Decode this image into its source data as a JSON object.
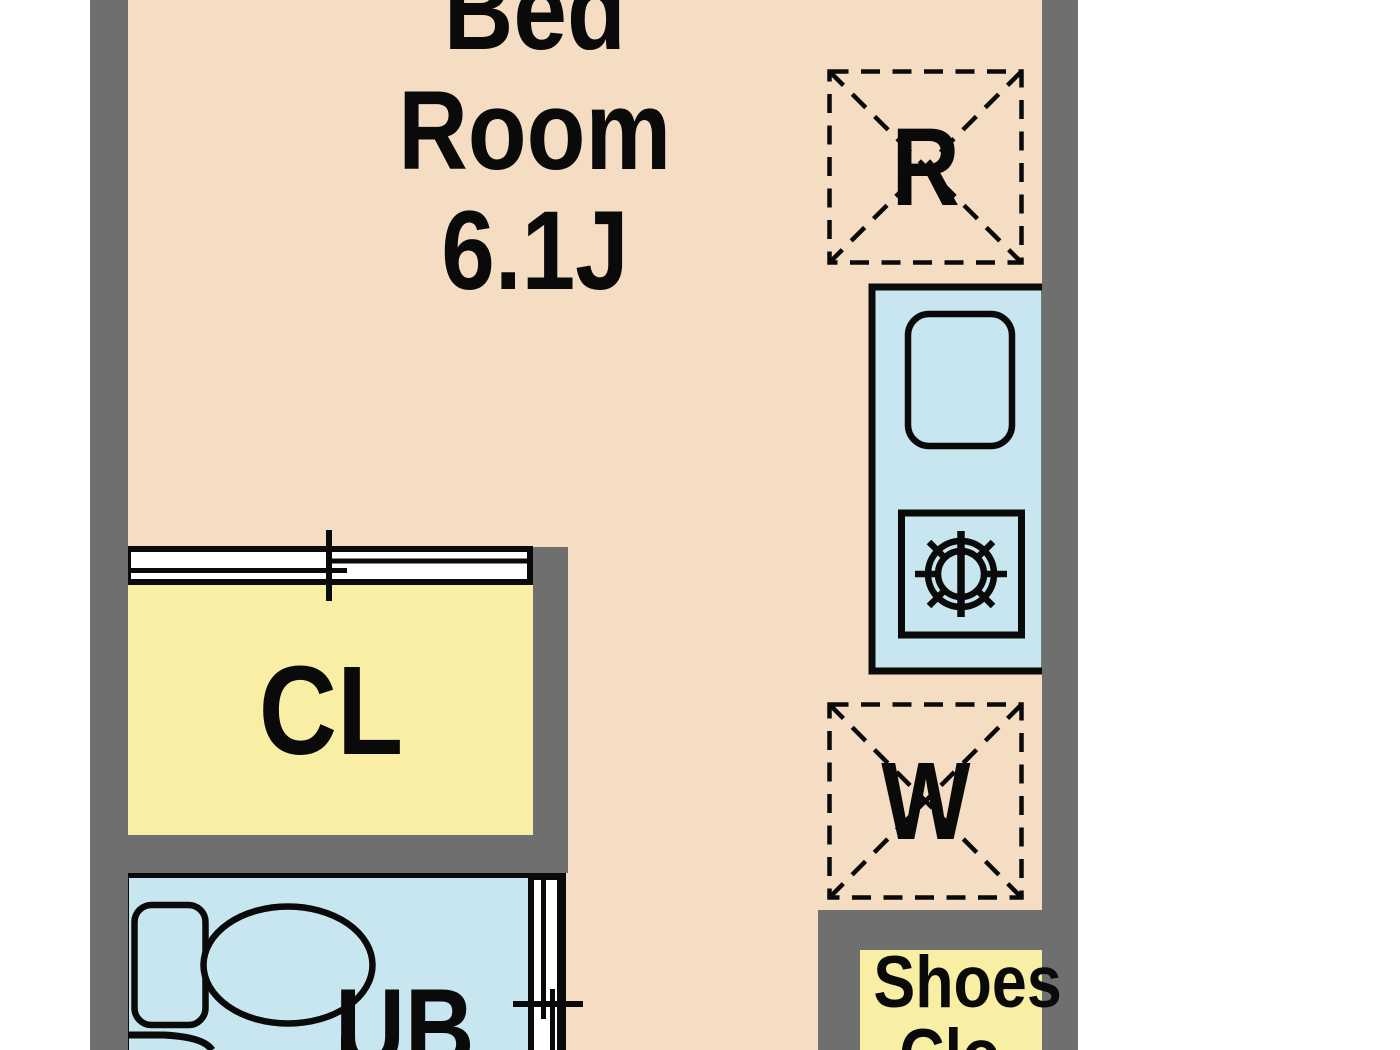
{
  "floorplan": {
    "type": "apartment-floor-plan",
    "colors": {
      "floor": "#f5ddc3",
      "wall": "#6f6f6f",
      "closet_fill": "#f8efa5",
      "wet_area_fill": "#c8e6ef",
      "door_fill": "#ffffff",
      "line": "#0a0a0a"
    },
    "rooms": {
      "bedroom": {
        "label_lines": [
          "Bed",
          "Room",
          "6.1J"
        ]
      },
      "closet": {
        "label": "CL"
      },
      "unit_bath": {
        "label": "UB"
      },
      "shoes_closet": {
        "label_lines": [
          "Shoes",
          "Clo"
        ]
      },
      "refrigerator_space": {
        "label": "R"
      },
      "washer_space": {
        "label": "W"
      }
    },
    "fixture_icons": [
      "toilet-icon",
      "bathtub-edge-icon",
      "kitchen-sink-icon",
      "gas-burner-icon",
      "sliding-door-closet-icon",
      "sliding-door-bath-icon",
      "refrigerator-space-box",
      "washer-space-box"
    ]
  }
}
